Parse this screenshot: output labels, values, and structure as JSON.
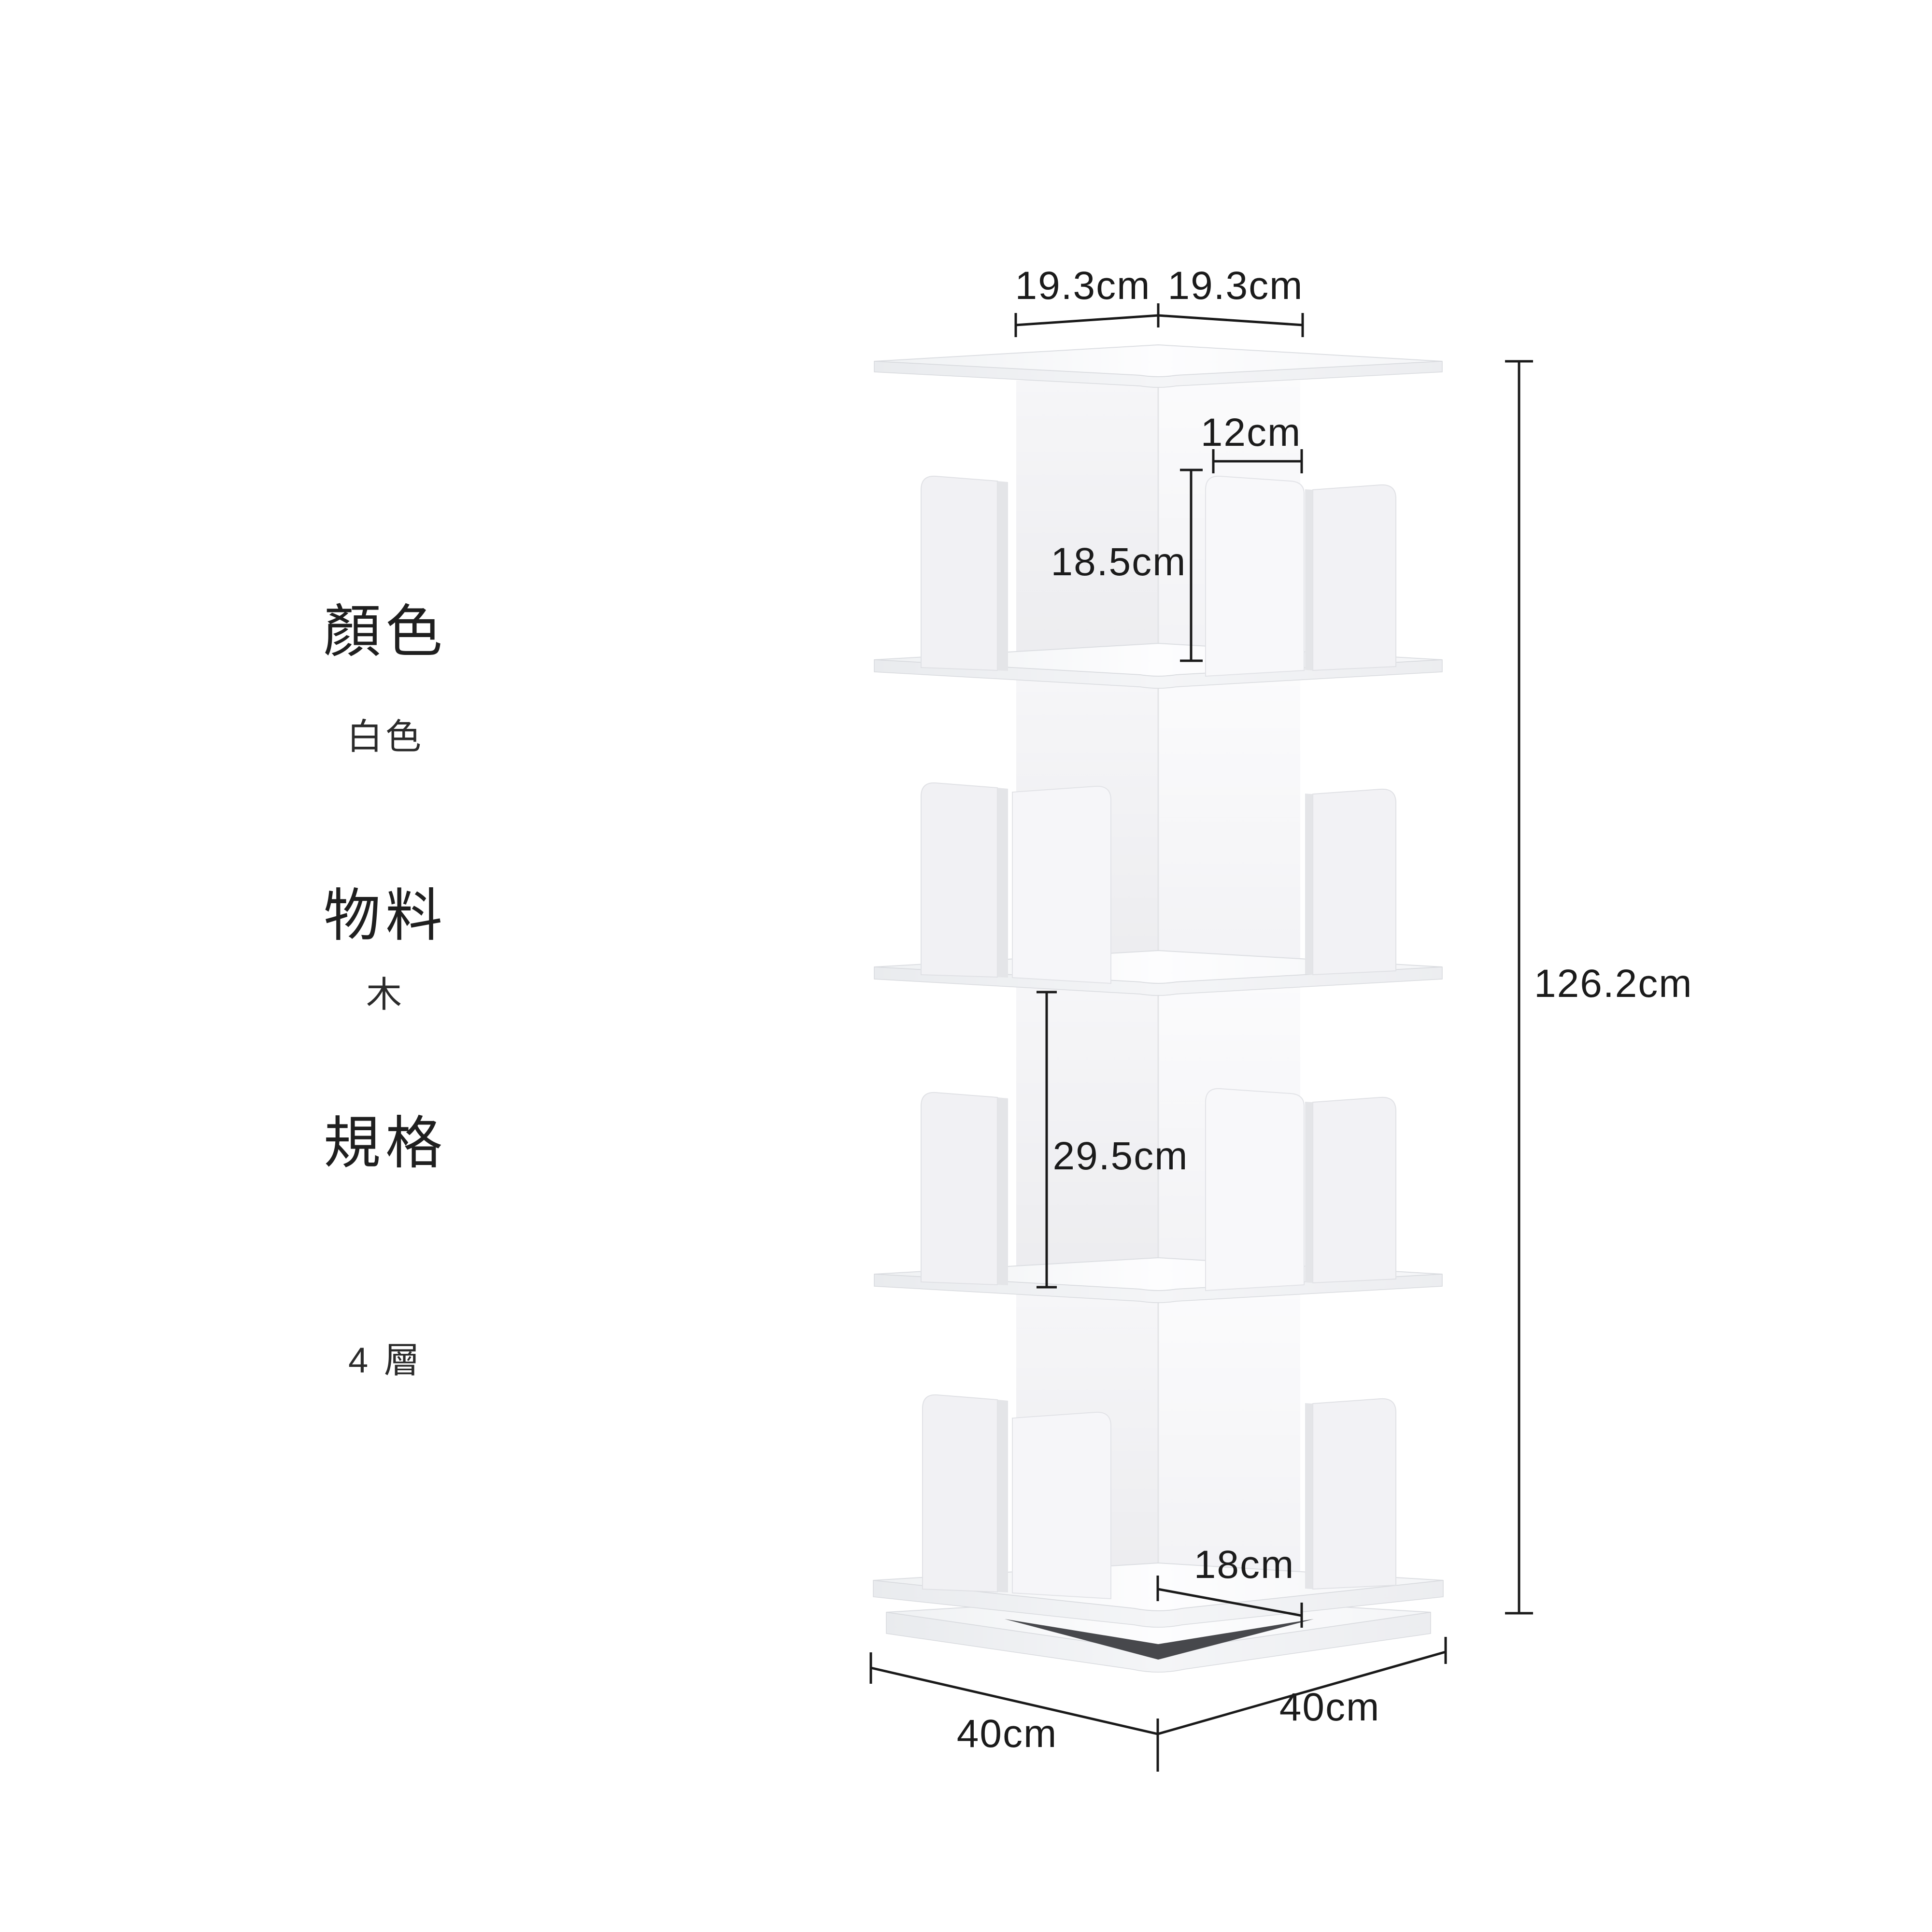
{
  "specs": {
    "items": [
      {
        "label": "顏色",
        "value": "白色"
      },
      {
        "label": "物料",
        "value": "木"
      },
      {
        "label": "規格",
        "value": "4 層"
      }
    ]
  },
  "dims": {
    "top_left_half_width": "19.3cm",
    "top_right_half_width": "19.3cm",
    "divider_width": "12cm",
    "tier1_inner_height": "18.5cm",
    "tier3_inner_height": "29.5cm",
    "base_inner_width": "18cm",
    "base_left_width": "40cm",
    "base_right_width": "40cm",
    "total_height": "126.2cm"
  },
  "colors": {
    "background": "#ffffff",
    "furniture_white": "#f7f8f9",
    "annotation": "#1c1c1c"
  }
}
